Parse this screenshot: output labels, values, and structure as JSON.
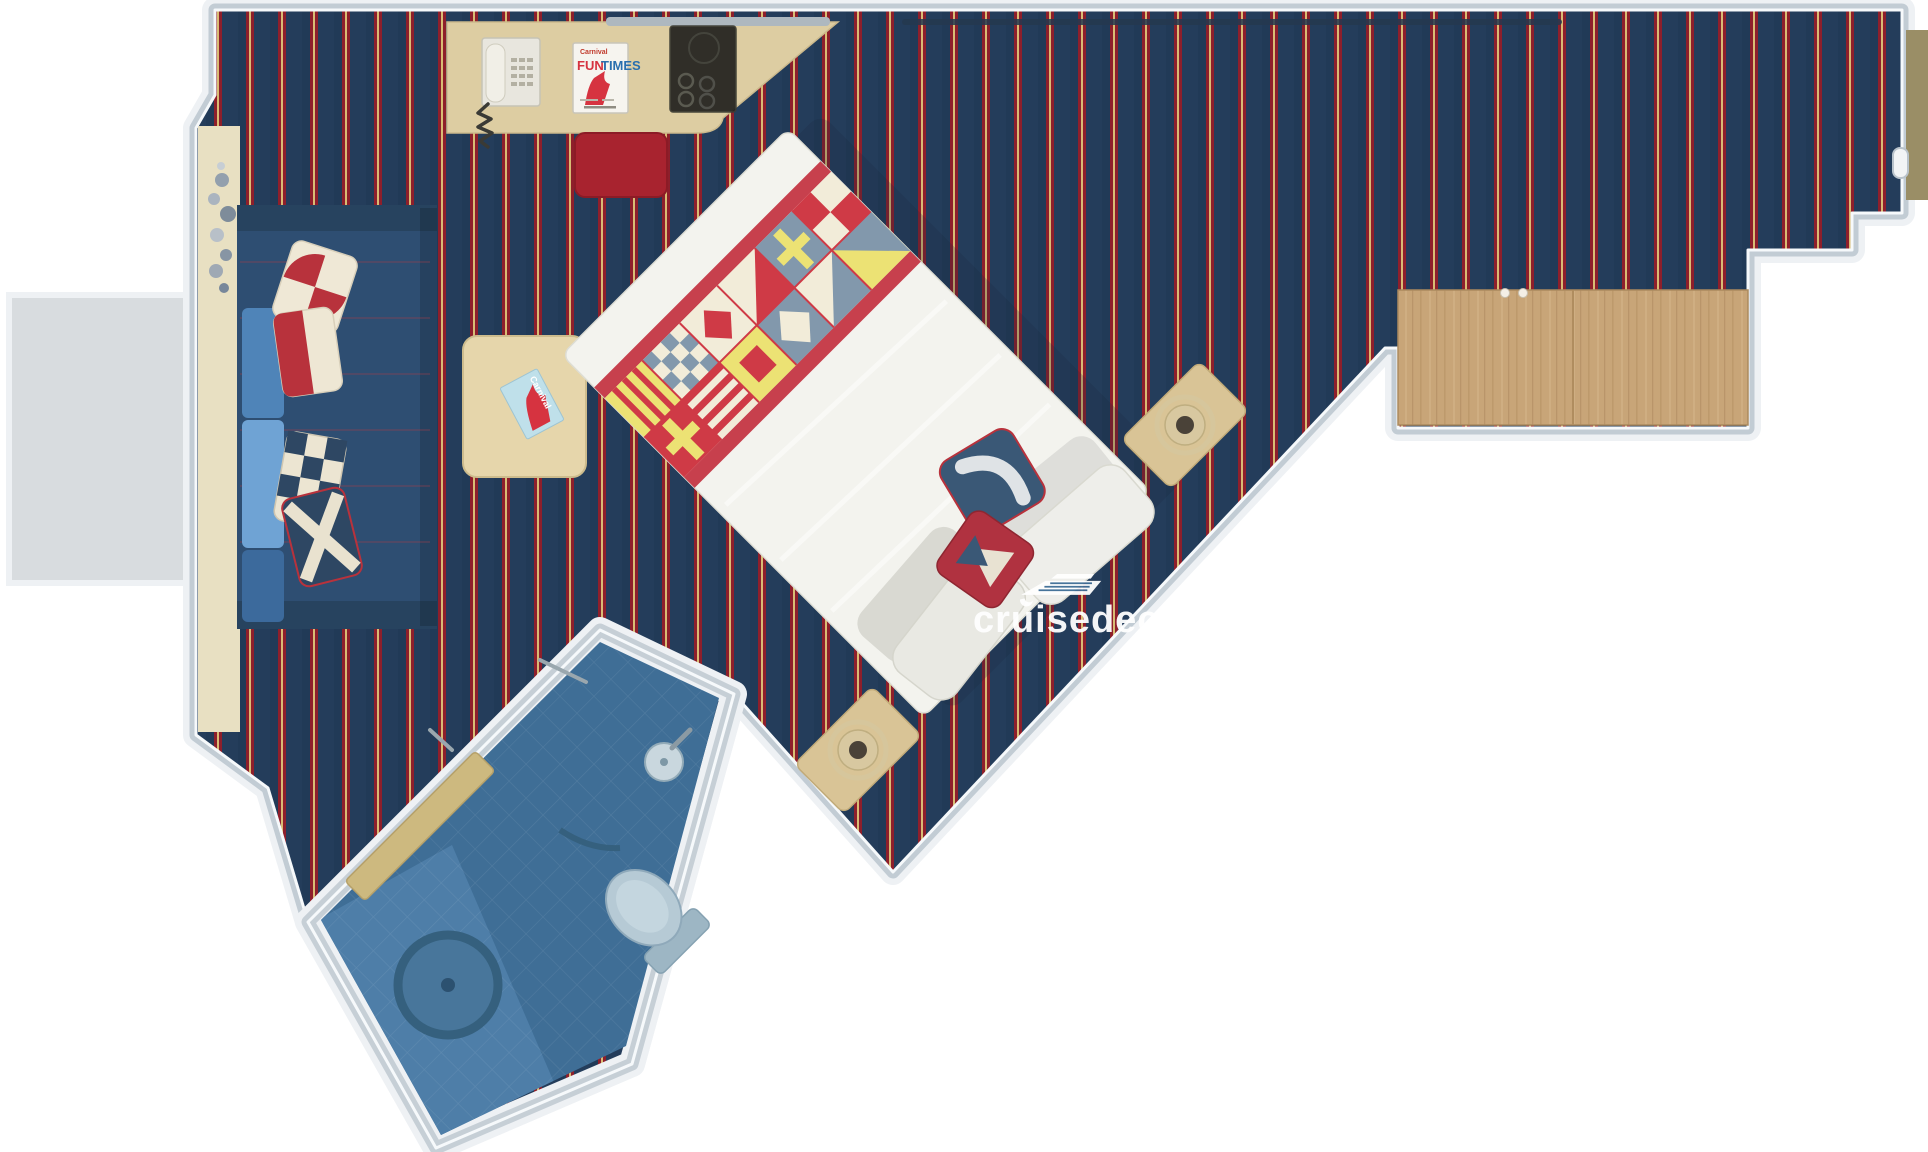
{
  "watermark": {
    "text": "cruisedeckplans",
    "icon": "cruise-ship-icon",
    "color": "#ffffff"
  },
  "desk_magazine": {
    "brand": "Carnival",
    "title_fun": "FUN",
    "title_times": "TIMES",
    "fun_color": "#d63340",
    "times_color": "#2a6fae"
  },
  "table_brochure": {
    "brand": "Carnival"
  },
  "scene": {
    "type": "cruise-cabin-floorplan-top-view",
    "palette": {
      "carpet_base": "#243d5b",
      "carpet_stripe_red": "#8e1f2b",
      "carpet_stripe_gold": "#d8bc74",
      "wall_grey": "#c2ccd4",
      "wood_tan": "#c8a578",
      "desk_tan": "#ddcda2",
      "sofa_navy": "#2e4e72",
      "sofa_cushion_blue": "#6fa3d4",
      "bed_white": "#f3f3ee",
      "flag_red": "#cf3a46",
      "flag_yellow": "#ece274",
      "flag_steel": "#8298ac",
      "bathroom_blue": "#3f6e96",
      "entry_door_olive": "#9a8e66",
      "stool_red": "#a8232f"
    },
    "furniture": [
      "balcony",
      "window",
      "sofa",
      "throw-pillows",
      "coffee-table",
      "brochure",
      "desk",
      "telephone",
      "fun-times-magazine",
      "bar-tray",
      "stool",
      "bed",
      "nautical-flag-runner",
      "bed-pillows",
      "nightstands",
      "lamps",
      "wardrobe",
      "bathroom",
      "toilet",
      "sink",
      "shower",
      "bathroom-door",
      "entry-door"
    ]
  }
}
